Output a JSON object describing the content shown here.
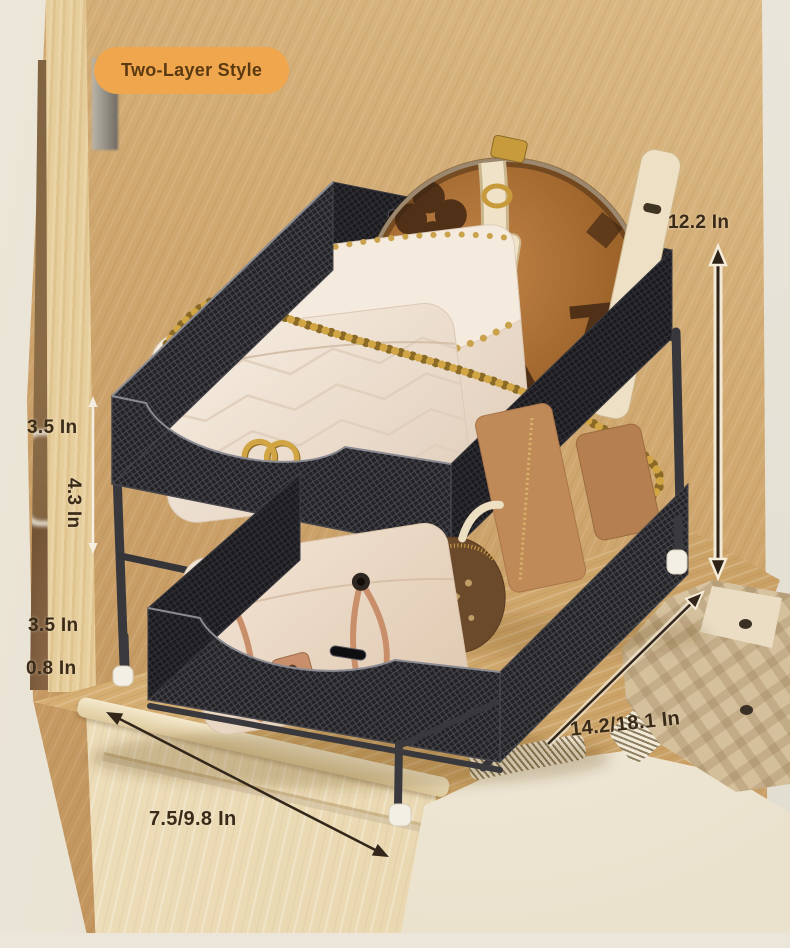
{
  "badge": {
    "label": "Two-Layer Style"
  },
  "dimensions": {
    "overall_height": "12.2 In",
    "upper_tier_height": "3.5 In",
    "tier_gap_height": "4.3 In",
    "lower_tier_height": "3.5 In",
    "base_clearance": "0.8 In",
    "length_range": "14.2/18.1 In",
    "depth_range": "7.5/9.8 In"
  },
  "colors": {
    "badge_bg": "#F0A64D",
    "badge_text": "#5C3A11",
    "dimension_text": "#3A2A18",
    "arrow_dark": "#2E2217",
    "arrow_light": "#F5ECD9",
    "rack_frame": "#3A3A3E",
    "rack_mesh": "#232327",
    "wood_wall": "#CFA76F",
    "cabinet_wood": "#EADBB4",
    "rug": "#F0E8D7"
  }
}
